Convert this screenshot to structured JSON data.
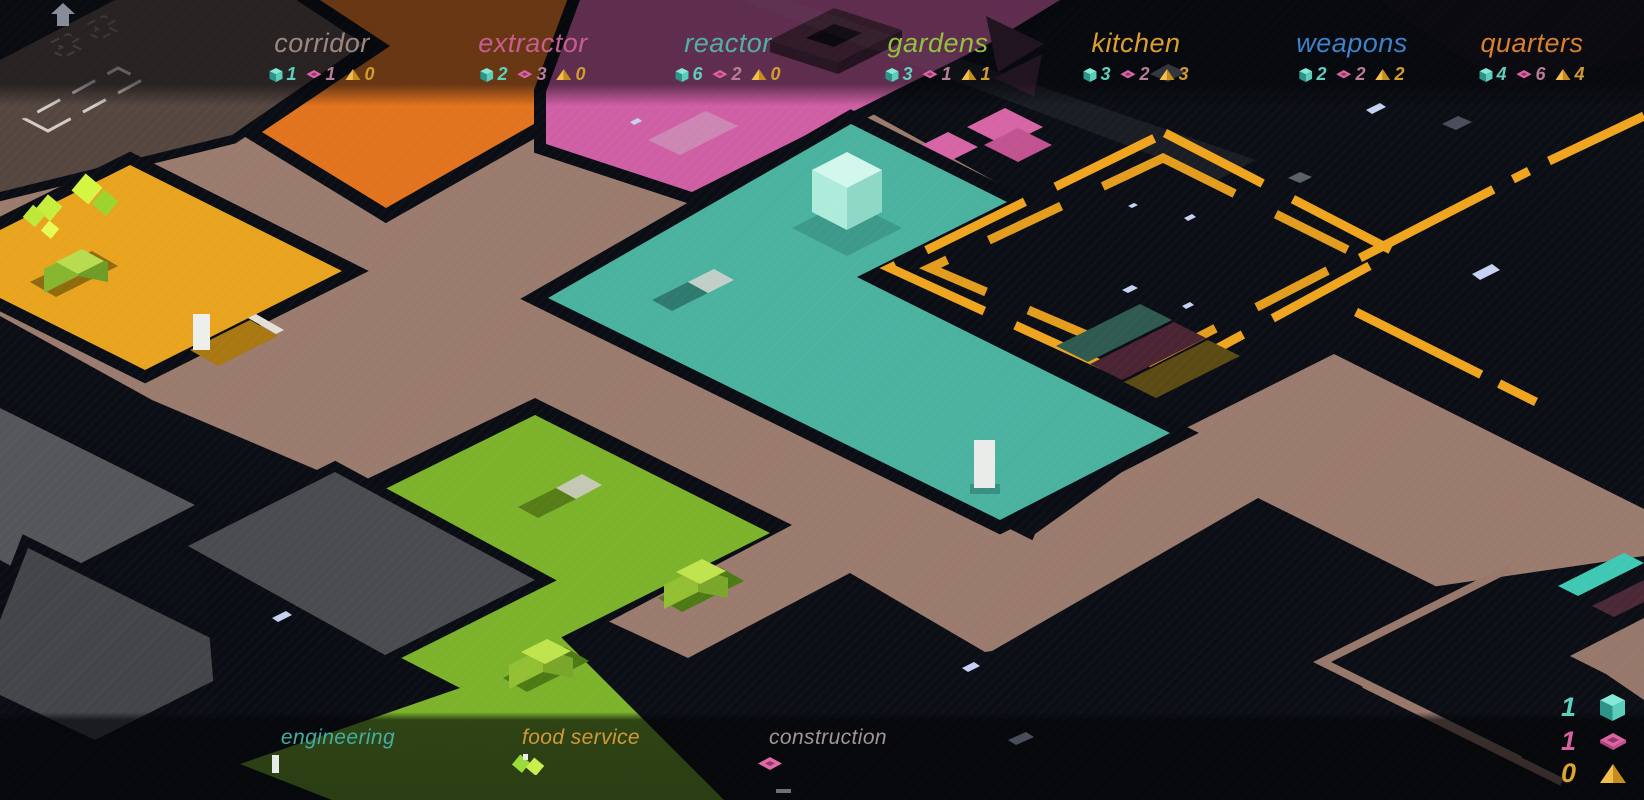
{
  "header": {
    "rooms": [
      {
        "name": "corridor",
        "color": "#9B8880",
        "cubes": 1,
        "plates": 1,
        "pyramids": 0
      },
      {
        "name": "extractor",
        "color": "#C75D90",
        "cubes": 2,
        "plates": 3,
        "pyramids": 0
      },
      {
        "name": "reactor",
        "color": "#52AFA6",
        "cubes": 6,
        "plates": 2,
        "pyramids": 0
      },
      {
        "name": "gardens",
        "color": "#93C23F",
        "cubes": 3,
        "plates": 1,
        "pyramids": 1
      },
      {
        "name": "kitchen",
        "color": "#DD9E2E",
        "cubes": 3,
        "plates": 2,
        "pyramids": 3
      },
      {
        "name": "weapons",
        "color": "#3E82C8",
        "cubes": 2,
        "plates": 2,
        "pyramids": 2
      },
      {
        "name": "quarters",
        "color": "#D8812F",
        "cubes": 4,
        "plates": 6,
        "pyramids": 4
      }
    ]
  },
  "footer": {
    "crews": [
      {
        "name": "engineering",
        "color": "#43AEA2"
      },
      {
        "name": "food service",
        "color": "#D29A35"
      },
      {
        "name": "construction",
        "color": "#A29598"
      }
    ]
  },
  "totals": {
    "cubes": 1,
    "plates": 1,
    "pyramids": 0
  },
  "resource_colors": {
    "cube": "#5FD0BE",
    "plate": "#D563A2",
    "pyramid": "#DFA42D",
    "cube_count": "#5FD0BE",
    "plate_count": "#BA7D97",
    "pyramid_count": "#D29C31"
  },
  "icons": {
    "home": "home-icon",
    "cube": "cube-resource-icon",
    "plate": "plate-resource-icon",
    "pyramid": "pyramid-resource-icon"
  },
  "map_colors": {
    "bg": "#0B0E14",
    "gap": "#0A0D13",
    "corridor_floor": "#9A7B6E",
    "plate_floor": "#564640",
    "orange": "#E2731F",
    "pink": "#CF5FA4",
    "teal": "#4BB2A0",
    "yellow": "#E8A41F",
    "green": "#7CB32B",
    "amber_outline": "#EFA51F",
    "gray_room": "#55565A",
    "gray_room_dark": "#444549",
    "charcoal": "#4A4B4F"
  }
}
